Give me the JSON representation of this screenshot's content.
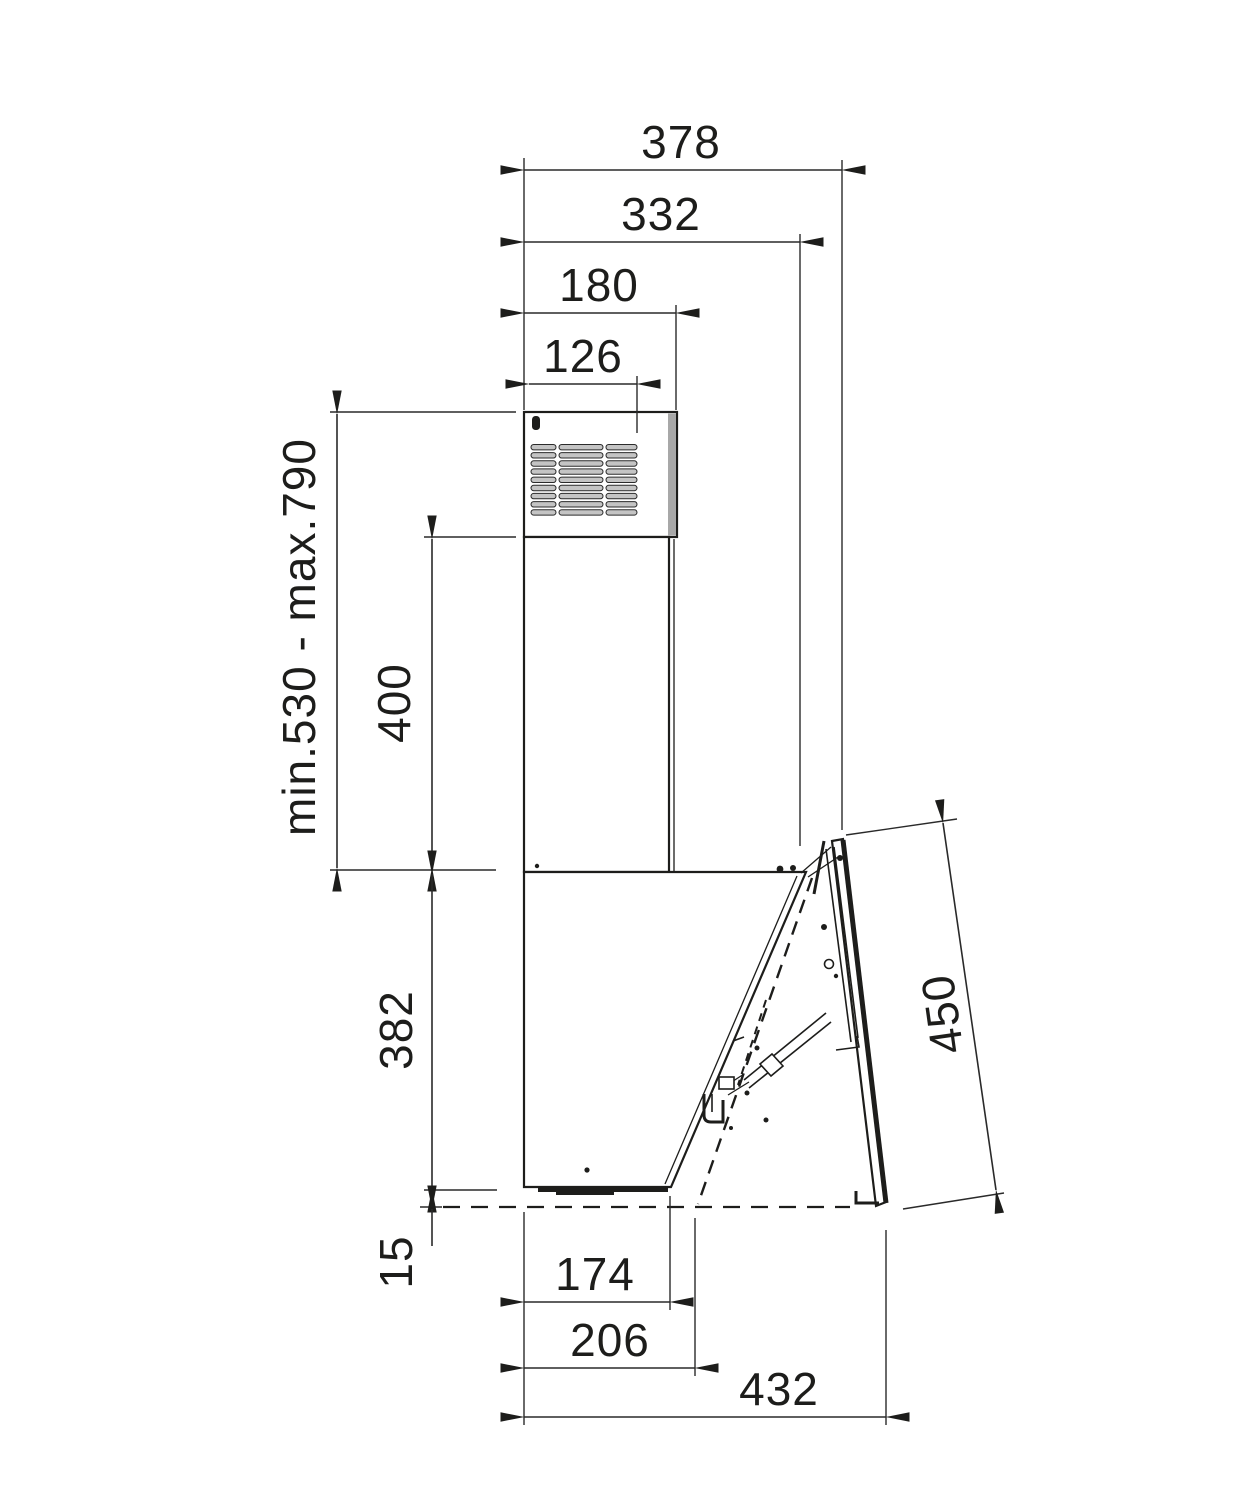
{
  "diagram_type": "appliance installation dimension drawing (wall-mounted cooker hood, side view)",
  "dims": {
    "overall_depth_top": "378",
    "depth_to_hinge": "332",
    "chimney_depth": "180",
    "duct_offset": "126",
    "mounting_height_range": "min.530 - max.790",
    "chimney_extension": "400",
    "body_height": "382",
    "clearance_below": "15",
    "front_panel_length": "450",
    "body_bottom_depth": "174",
    "bottom_depth_open": "206",
    "overall_depth_bottom": "432"
  },
  "colors": {
    "background": "#ffffff",
    "line": "#1d1d1b",
    "dimline": "#2a2a2a",
    "shade": "#a8a8a8",
    "slat": "#c4c4c4"
  }
}
